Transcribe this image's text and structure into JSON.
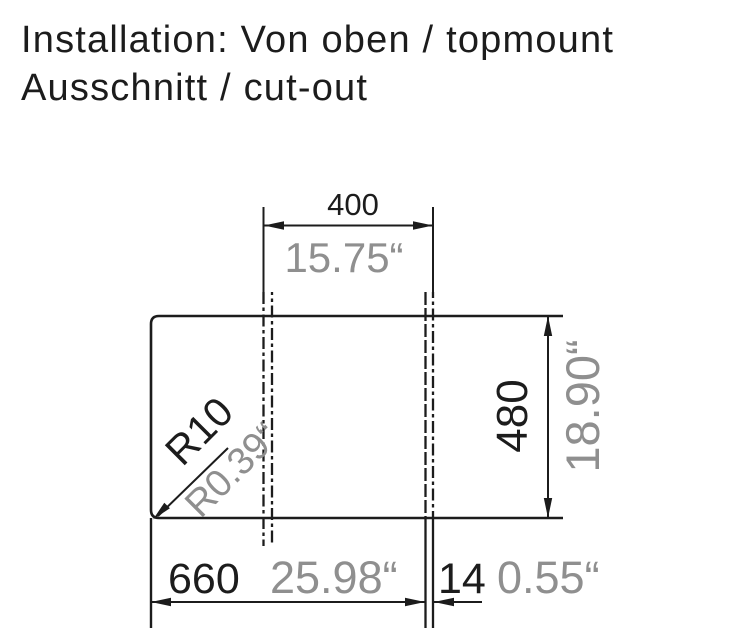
{
  "title": {
    "line1": "Installation: Von oben / topmount",
    "line2": "Ausschnitt / cut-out"
  },
  "colors": {
    "line": "#1c1c1c",
    "metric_text": "#1c1c1c",
    "inch_text": "#8f8f8f",
    "background": "#ffffff"
  },
  "drawing": {
    "type": "technical-cutout-dimension-drawing",
    "dimensions": {
      "top_width": {
        "mm": "400",
        "inch": "15.75“"
      },
      "height": {
        "mm": "480",
        "inch": "18.90“"
      },
      "bottom_width": {
        "mm": "660",
        "inch": "25.98“"
      },
      "edge_offset": {
        "mm": "14",
        "inch": "0.55“"
      },
      "corner_radius": {
        "mm": "R10",
        "inch": "R0.39“"
      }
    }
  }
}
